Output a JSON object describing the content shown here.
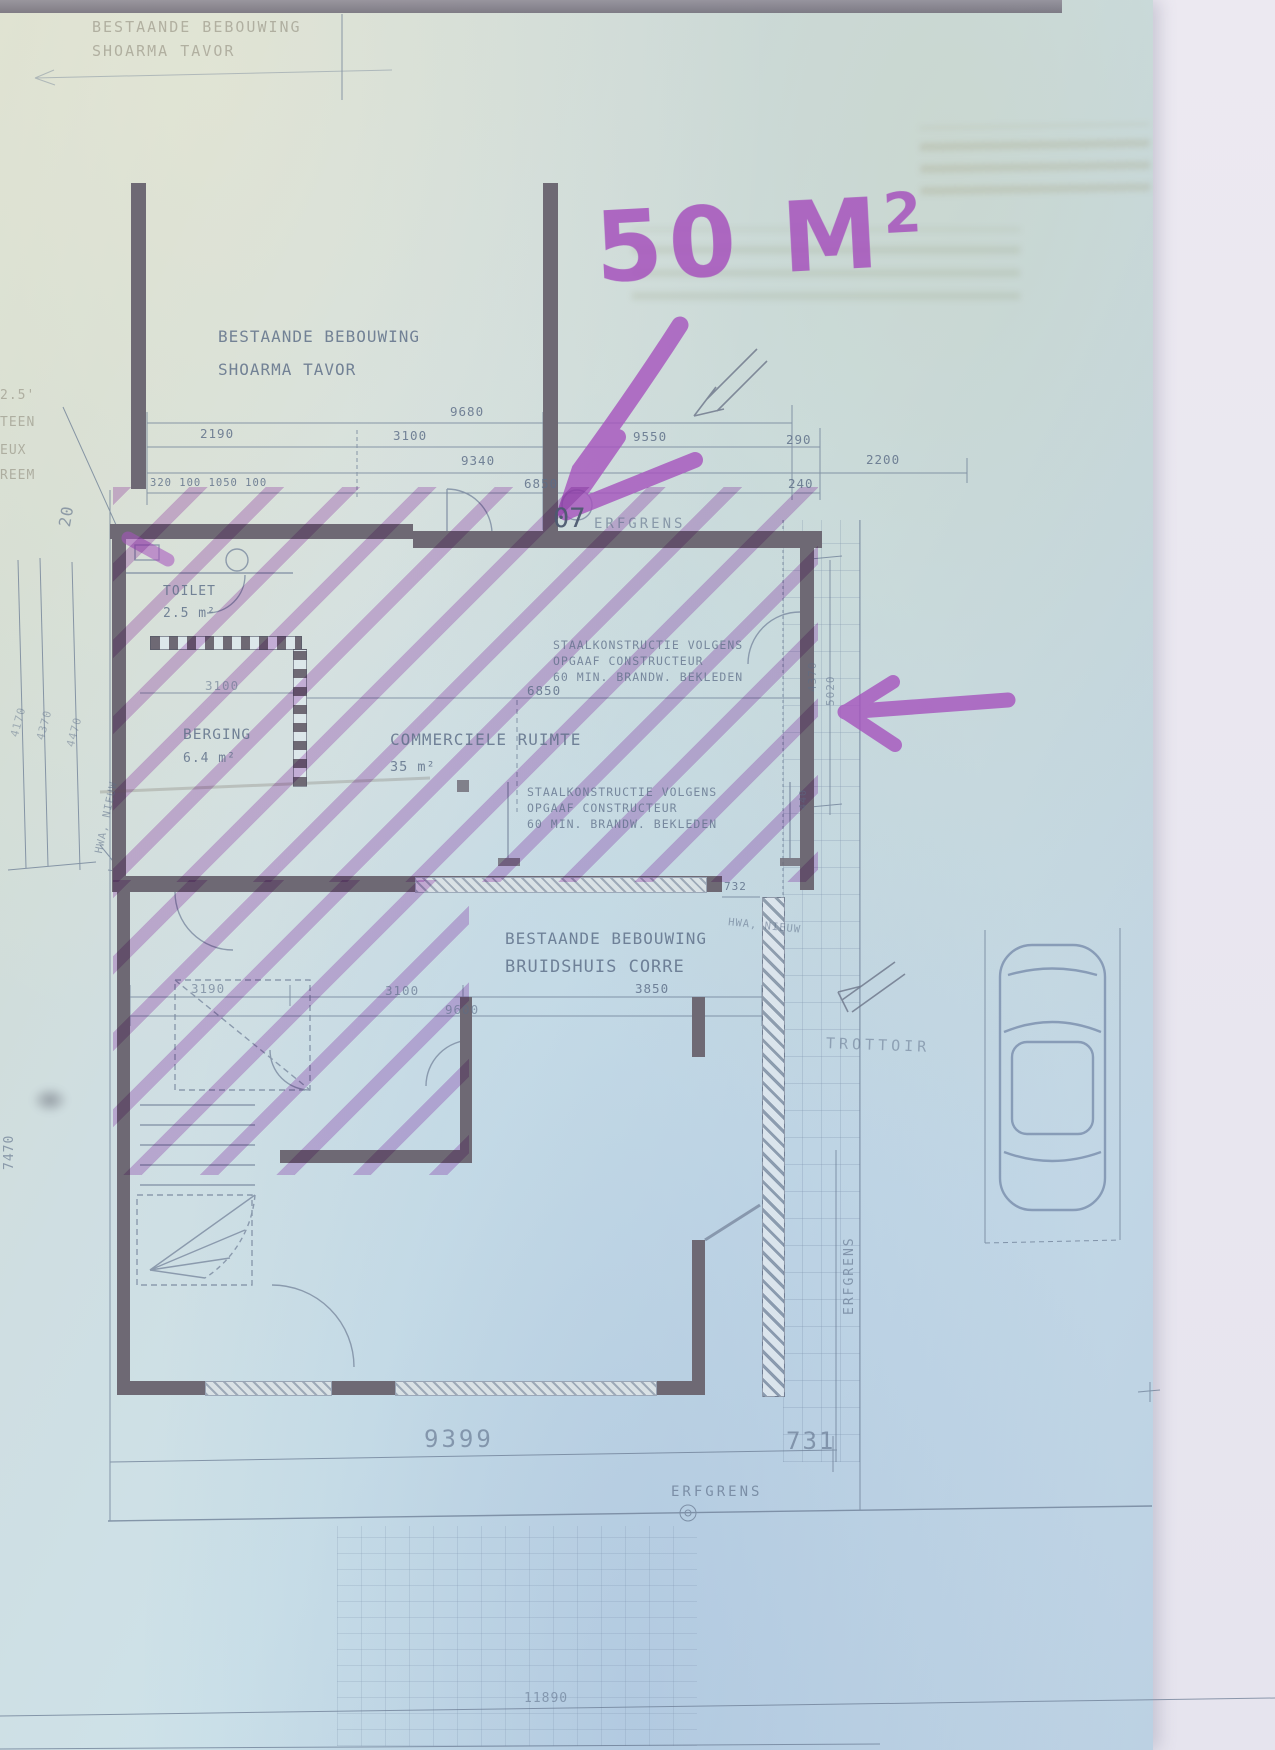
{
  "top_sheet": {
    "line1": "BESTAANDE BEBOUWING",
    "line2": "SHOARMA TAVOR"
  },
  "upper_building": {
    "line1": "BESTAANDE BEBOUWING",
    "line2": "SHOARMA TAVOR"
  },
  "marker": {
    "area_text": "50 M",
    "superscript": "2",
    "color": "#a653bd"
  },
  "boundary": {
    "number": "07",
    "erfgrens_top": "ERFGRENS",
    "erfgrens_bottom": "ERFGRENS",
    "erfgrens_right": "ERFGRENS"
  },
  "rooms": {
    "toilet": {
      "name": "TOILET",
      "area": "2.5 m²"
    },
    "berging": {
      "name": "BERGING",
      "area": "6.4 m²"
    },
    "commercial": {
      "name": "COMMERCIELE RUIMTE",
      "area": "35 m²"
    }
  },
  "notes": {
    "steel_line1": "STAALKONSTRUCTIE VOLGENS",
    "steel_line2": "OPGAAF CONSTRUCTEUR",
    "steel_line3": "60 MIN. BRANDW. BEKLEDEN"
  },
  "lower_building": {
    "line1": "BESTAANDE BEBOUWING",
    "line2": "BRUIDSHUIS CORRE"
  },
  "street": {
    "trottoir": "TROTTOIR"
  },
  "dims": {
    "d9680": "9680",
    "d2190": "2190",
    "d3100a": "3100",
    "d9550": "9550",
    "d290": "290",
    "d9340": "9340",
    "d2200": "2200",
    "d240": "240",
    "row_small": "320 100 1050 100",
    "d6850a": "6850",
    "d3100b": "3100",
    "d6850b": "6850",
    "d3190": "3190",
    "d3100c": "3100",
    "d3850": "3850",
    "d9600": "9600",
    "d732": "732",
    "d9399": "9399",
    "d731": "731",
    "d11890": "11890",
    "d7470": "7470",
    "d20": "20",
    "d4170": "4170",
    "d4370l": "4370",
    "d4470": "4470",
    "d4370r": "4370",
    "d5020": "5020",
    "d440": "440"
  },
  "annotations": {
    "hwa_left": "HWA, NIEUW",
    "hwa_right": "HWA, NIEUW"
  },
  "margin_fragments": {
    "f1": "2.5'",
    "f2": "TEEN",
    "f3": "EUX",
    "f4": "REEM"
  }
}
